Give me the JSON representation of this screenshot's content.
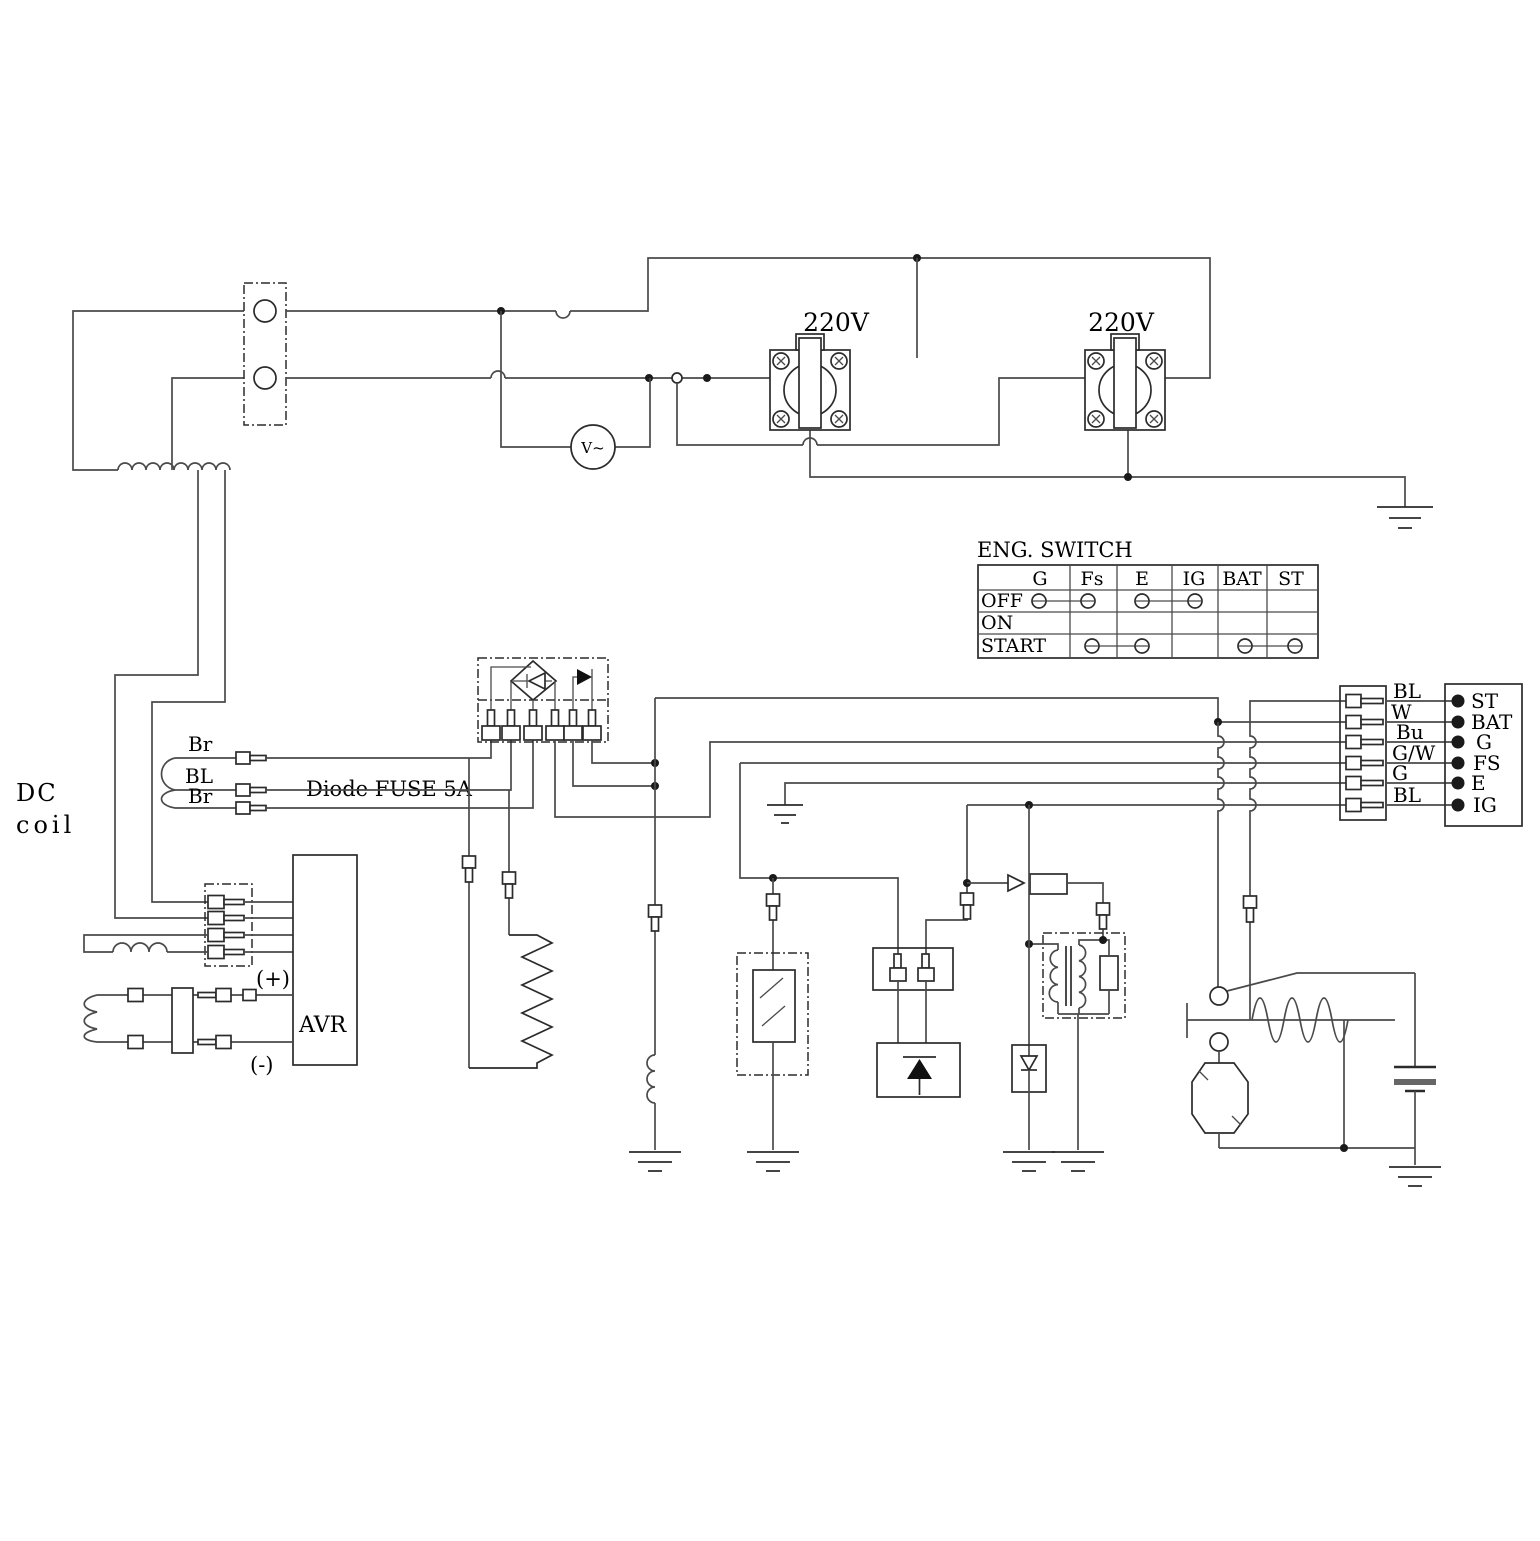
{
  "colors": {
    "line": "#4a4a4a",
    "component": "#2b2b2b",
    "text": "#000000",
    "background": "#ffffff"
  },
  "labels": {
    "dc_coil_line1": "DC",
    "dc_coil_line2": "coil",
    "diode_fuse": "Diode FUSE 5A",
    "avr": "AVR",
    "avr_positive": "(+)",
    "avr_negative": "(-)",
    "voltmeter": "V~",
    "outlet_left": "220V",
    "outlet_right": "220V"
  },
  "stator_wire_labels": [
    "Br",
    "BL",
    "Br"
  ],
  "eng_switch": {
    "title": "ENG. SWITCH",
    "columns": [
      "G",
      "Fs",
      "E",
      "IG",
      "BAT",
      "ST"
    ],
    "rows": [
      {
        "label": "OFF",
        "connections": [
          [
            "G",
            "Fs"
          ],
          [
            "E",
            "IG"
          ]
        ]
      },
      {
        "label": "ON",
        "connections": []
      },
      {
        "label": "START",
        "connections": [
          [
            "Fs",
            "E"
          ],
          [
            "BAT",
            "ST"
          ]
        ]
      }
    ]
  },
  "harness": {
    "wire_labels": [
      "BL",
      "W",
      "Bu",
      "G/W",
      "G",
      "BL"
    ]
  },
  "terminal_block": {
    "labels": [
      "ST",
      "BAT",
      "G",
      "FS",
      "E",
      "IG"
    ]
  },
  "component_names": [
    "main-winding",
    "output-connector",
    "voltmeter",
    "power-outlet-left",
    "power-outlet-right",
    "engine-switch-table",
    "diode-fuse-rectifier",
    "dc-coil-winding",
    "avr",
    "avr-connector",
    "field-winding-fuse",
    "load-resistor",
    "charging-coil",
    "oil-level-sensor",
    "pulser-connector",
    "scr-unit",
    "ignition-coil",
    "zener-diode",
    "starter-relay",
    "starter-motor",
    "battery",
    "harness-connector",
    "terminal-block"
  ]
}
